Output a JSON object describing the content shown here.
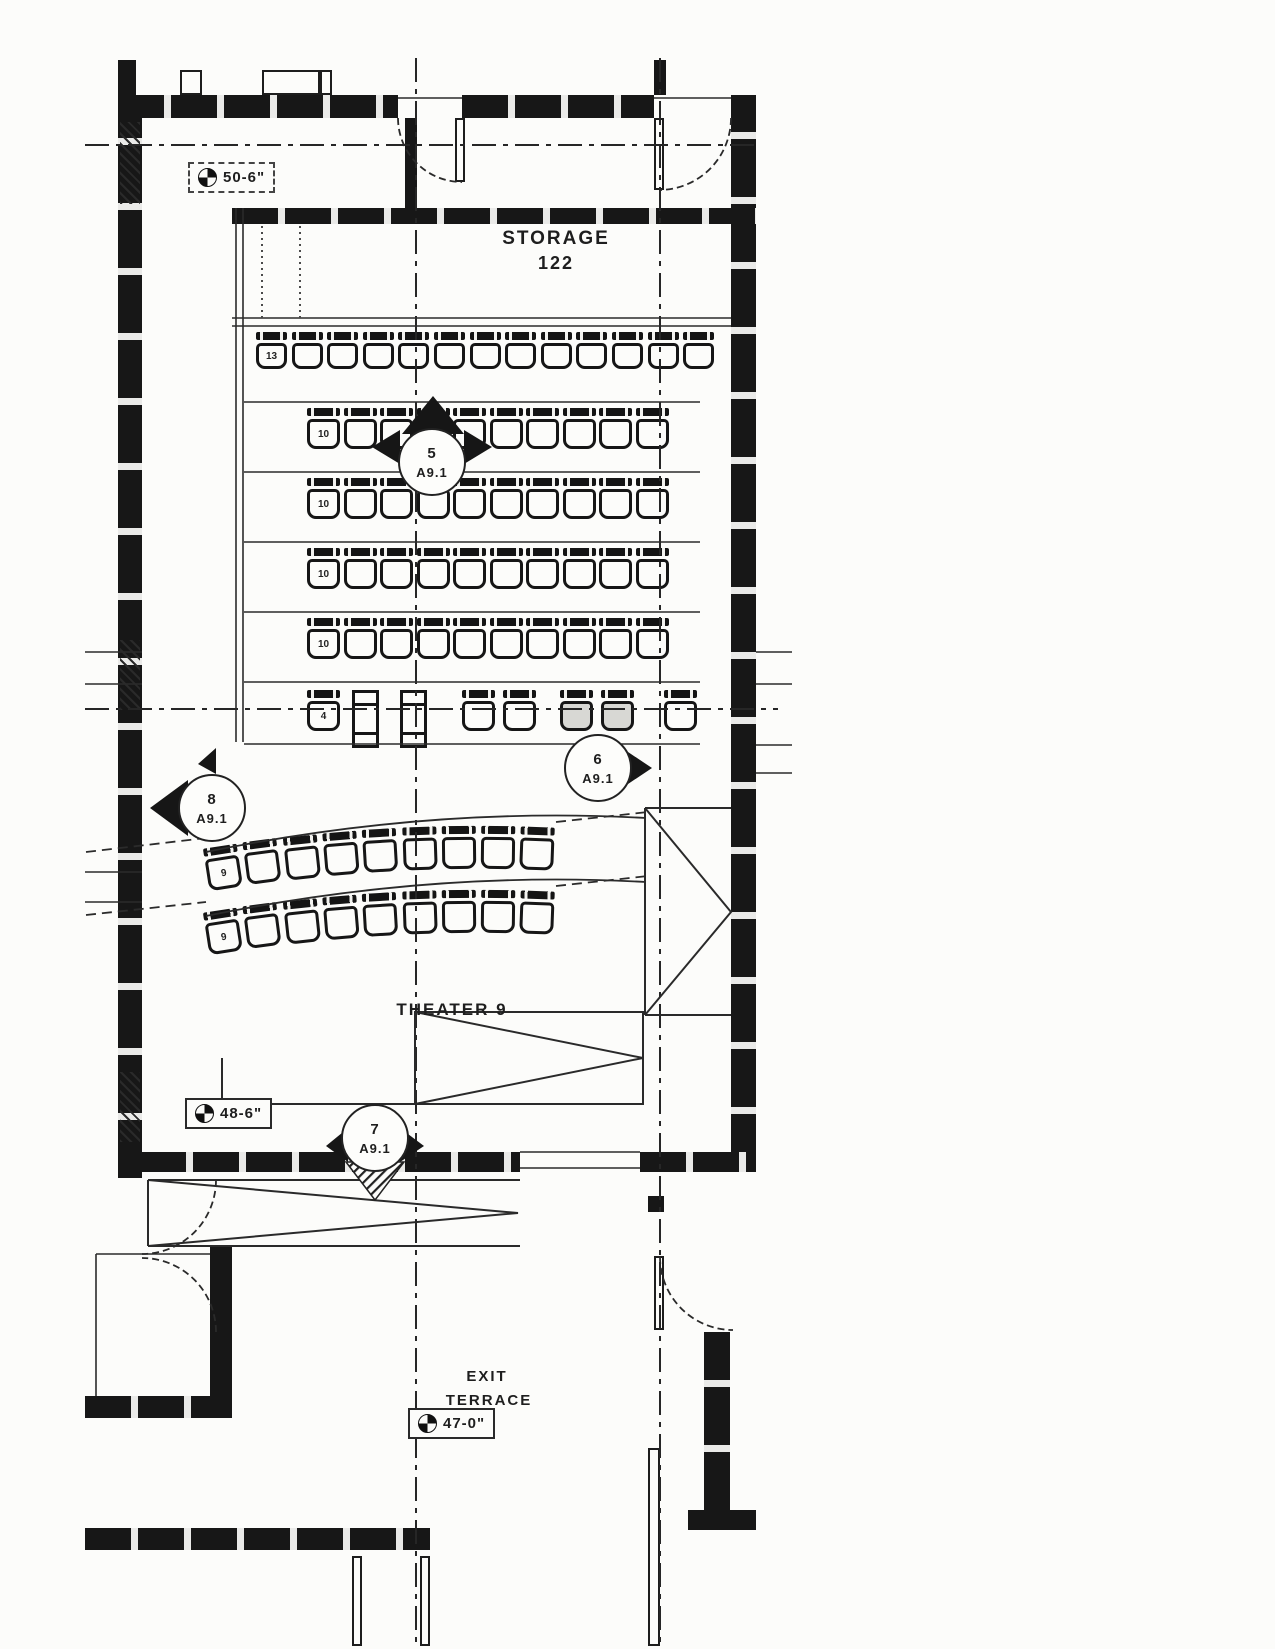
{
  "plan": {
    "storage": {
      "name": "STORAGE",
      "number": "122"
    },
    "theater": {
      "name": "THEATER 9"
    },
    "terrace": {
      "line1": "EXIT",
      "line2": "TERRACE"
    },
    "elevations": {
      "upper": {
        "label": "50-6\""
      },
      "mid": {
        "label": "48-6\""
      },
      "lower": {
        "label": "47-0\""
      }
    },
    "callouts": {
      "c5": {
        "number": "5",
        "sheet": "A9.1"
      },
      "c6": {
        "number": "6",
        "sheet": "A9.1"
      },
      "c7": {
        "number": "7",
        "sheet": "A9.1"
      },
      "c8": {
        "number": "8",
        "sheet": "A9.1"
      }
    },
    "seat_rows": [
      {
        "id": "back",
        "count": 13,
        "first_seat_label": "13"
      },
      {
        "id": "mid1",
        "count": 10,
        "first_seat_label": "10"
      },
      {
        "id": "mid2",
        "count": 10,
        "first_seat_label": "10"
      },
      {
        "id": "mid3",
        "count": 10,
        "first_seat_label": "10"
      },
      {
        "id": "mid4",
        "count": 10,
        "first_seat_label": "10"
      },
      {
        "id": "front",
        "count": 6,
        "first_seat_label": "4"
      },
      {
        "id": "curve1",
        "count": 9,
        "first_seat_label": "9"
      },
      {
        "id": "curve2",
        "count": 9,
        "first_seat_label": "9"
      }
    ],
    "colors": {
      "ink": "#1c1c1c",
      "paper": "#fcfcfa"
    }
  }
}
